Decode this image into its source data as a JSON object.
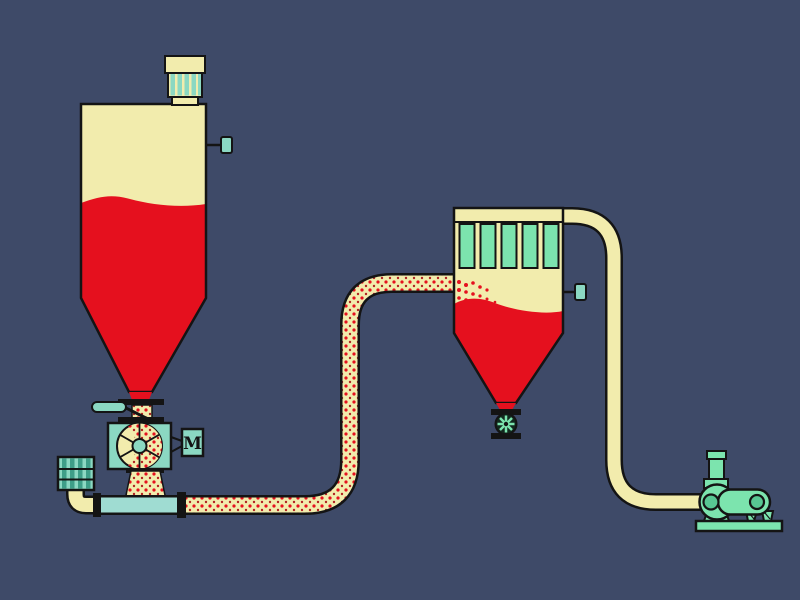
{
  "labels": {
    "motor": "M"
  },
  "colors": {
    "background": "#3E4A68",
    "vessel-cream": "#F2ECAD",
    "material-red": "#E5101E",
    "material-red-dark": "#B02222",
    "pipe-teal": "#9FDCD2",
    "equipment-teal": "#8BD8C2",
    "stripe-teal-dark": "#3E9E88",
    "mint-green": "#7CE4AE",
    "mint-dark": "#58C793",
    "outline": "#141414"
  },
  "components": [
    "feed-silo",
    "silo-vent-filter",
    "silo-level-sensor",
    "slide-gate-valve",
    "rotary-airlock-valve",
    "rotary-valve-motor",
    "intake-air-filter-silencer",
    "conveying-pipeline",
    "filter-receiver",
    "filter-elements",
    "receiver-level-sensor",
    "receiver-discharge-valve",
    "vacuum-line",
    "vacuum-pump",
    "exhaust-stack"
  ]
}
